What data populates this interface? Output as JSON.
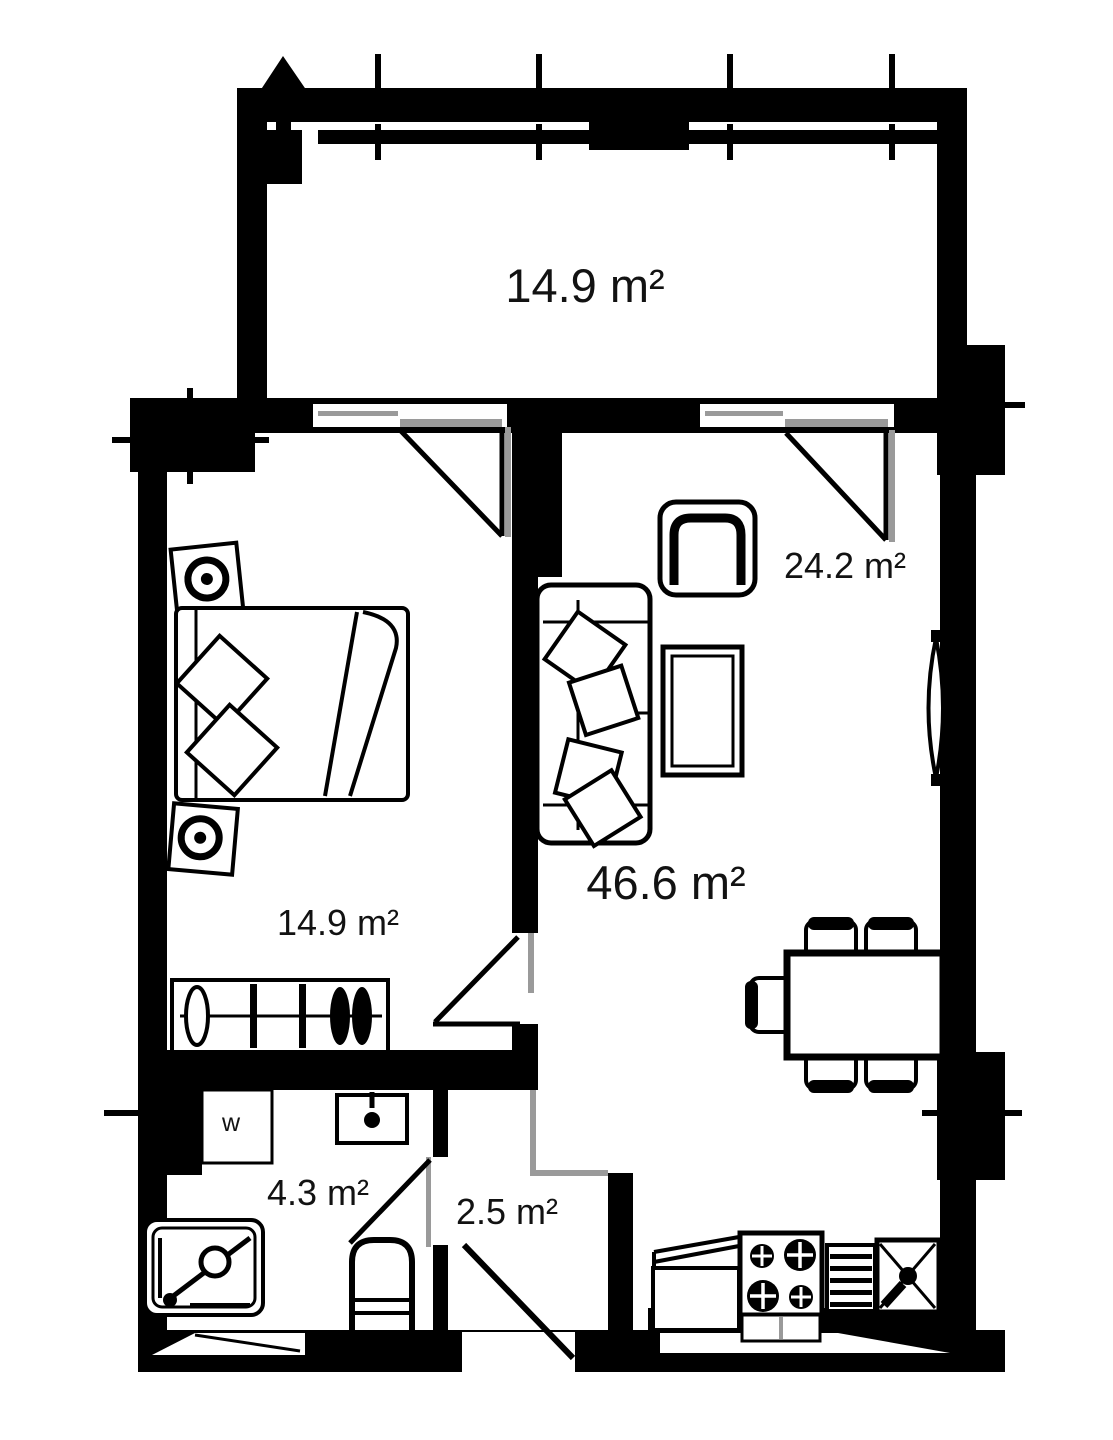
{
  "floor_plan": {
    "rooms": {
      "balcony": {
        "area": "14.9 m²"
      },
      "bedroom": {
        "area": "14.9 m²"
      },
      "living_room": {
        "area": "46.6 m²"
      },
      "living_zone": {
        "area": "24.2 m²"
      },
      "bathroom": {
        "area": "4.3 m²"
      },
      "hallway": {
        "area": "2.5 m²"
      }
    },
    "labels": {
      "washer": "w"
    },
    "colors": {
      "walls": "#000000",
      "background": "#ffffff",
      "sill_gray": "#9a9a9a"
    }
  }
}
